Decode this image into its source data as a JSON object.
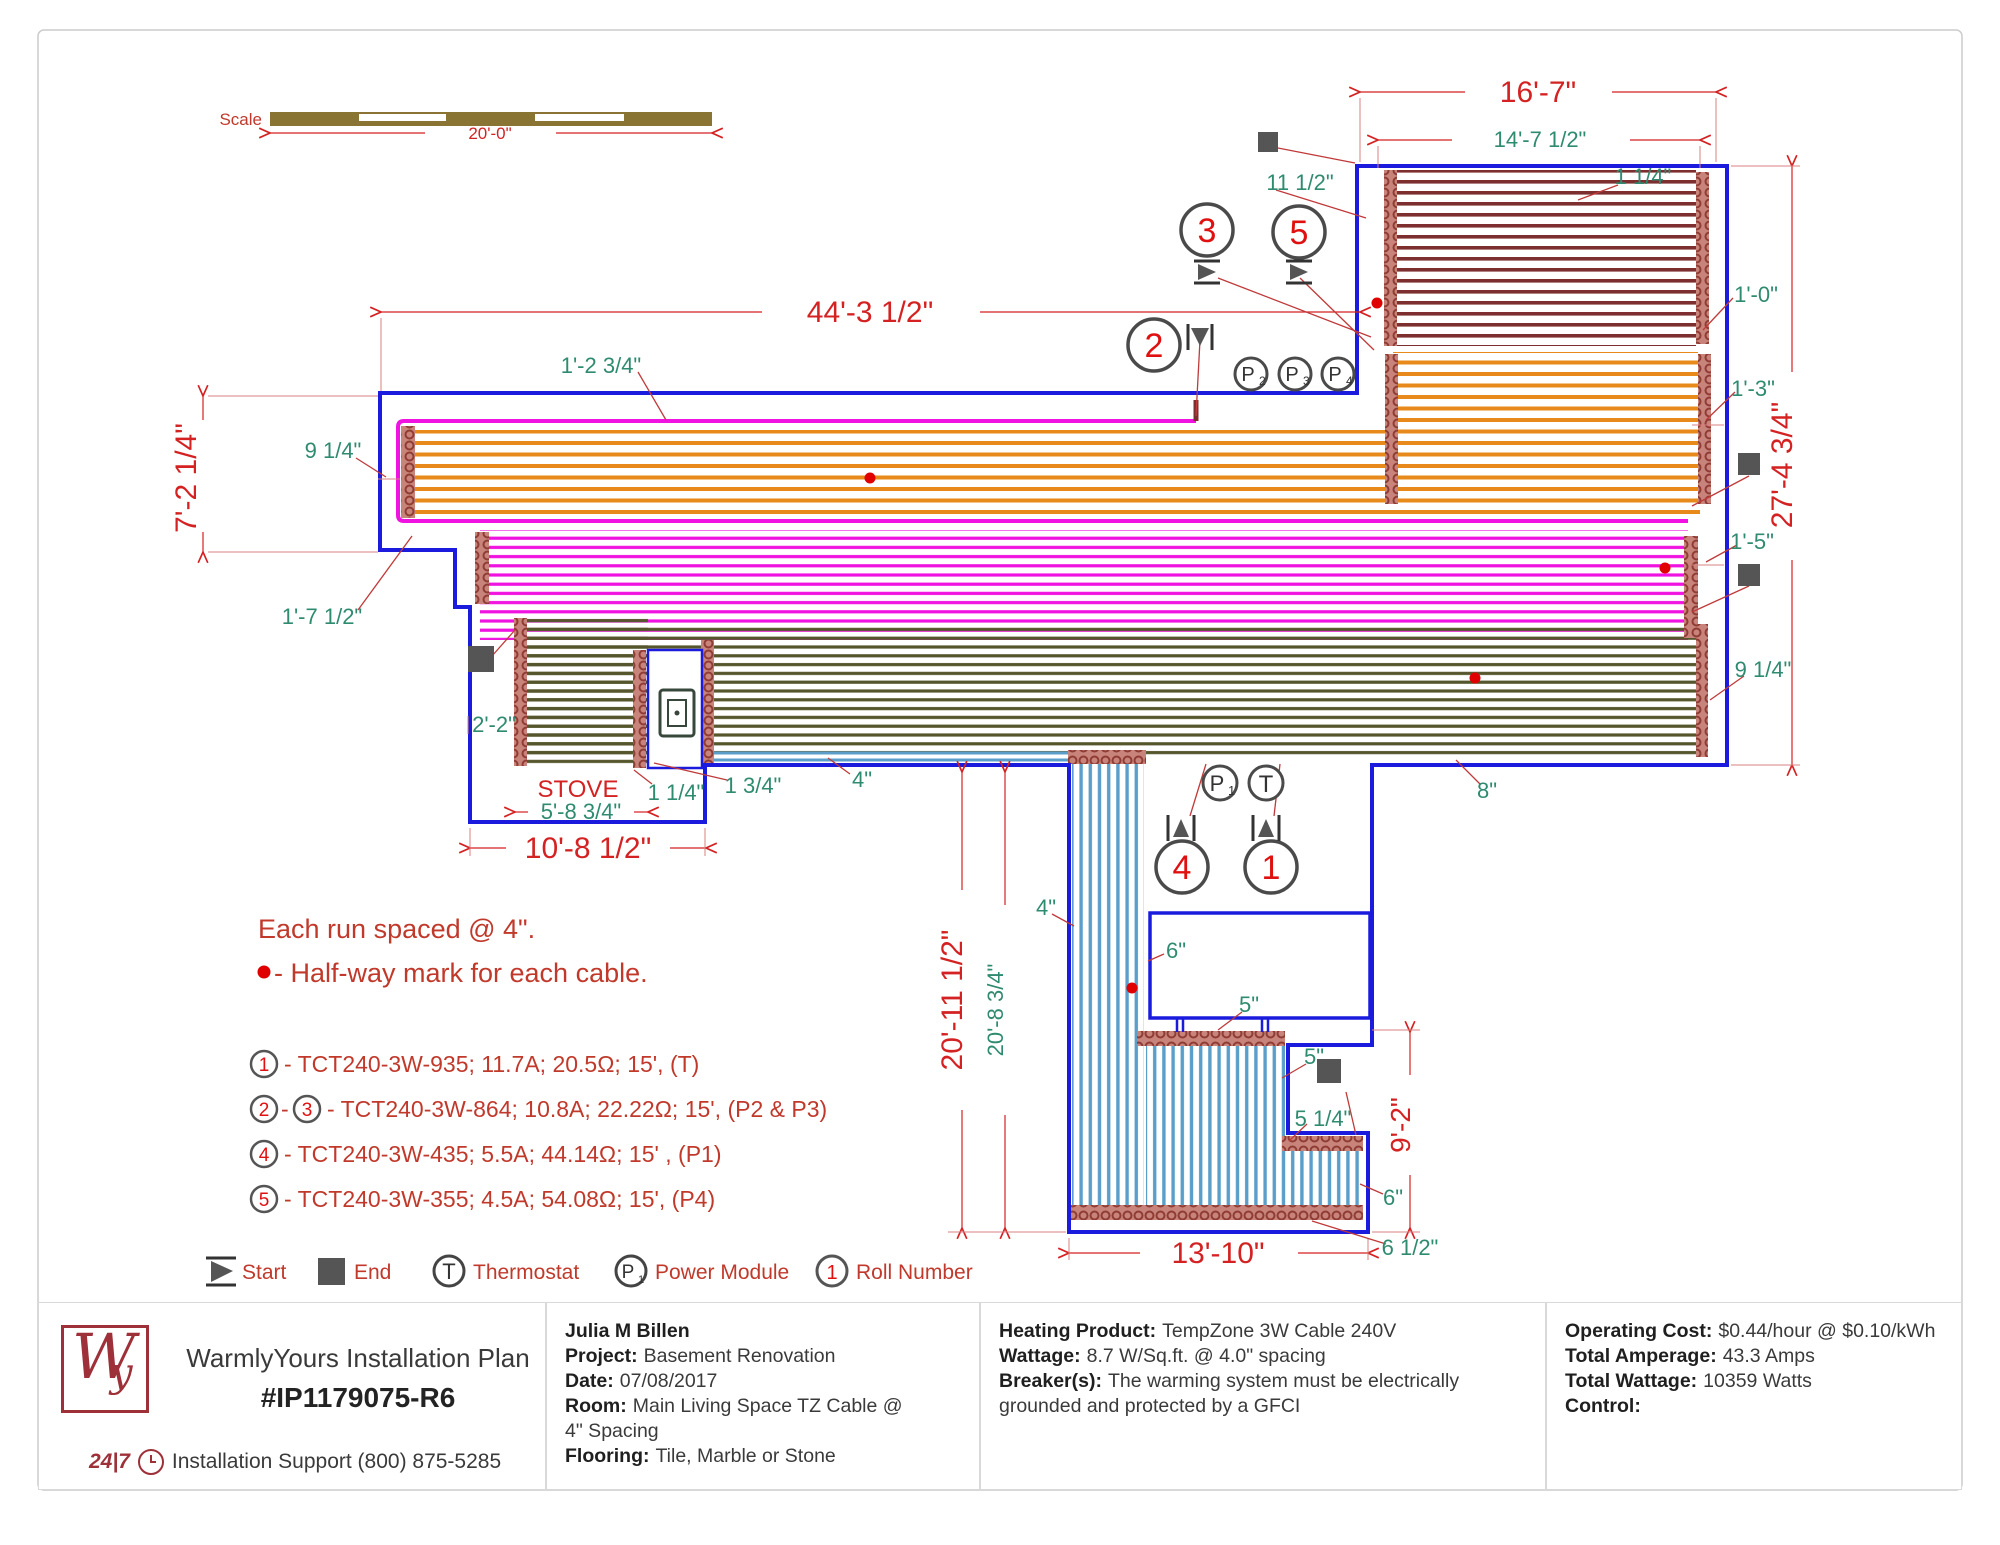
{
  "scale": {
    "label": "Scale",
    "length": "20'-0\""
  },
  "dims": {
    "top_width": "16'-7\"",
    "top_inner_width": "14'-7 1/2\"",
    "top_offset": "1 1/4\"",
    "top_left_offset": "11 1/2\"",
    "right_offset_a": "1'-0\"",
    "main_width": "44'-3 1/2\"",
    "band_offset": "1'-2 3/4\"",
    "left_height": "7'-2 1/4\"",
    "left_loop_offset": "9 1/4\"",
    "left_step": "1'-7 1/2\"",
    "right_offset_b": "1'-3\"",
    "right_height": "27'-4 3/4\"",
    "right_offset_c": "1'-5\"",
    "right_loop_offset": "9 1/4\"",
    "stove_offset": "2'-2\"",
    "stove_width": "5'-8 3/4\"",
    "left_block_width": "10'-8 1/2\"",
    "gap_a": "1 1/4\"",
    "gap_b": "1 3/4\"",
    "gap_c": "4\"",
    "olive_gap": "8\"",
    "mid_gap": "4\"",
    "bottom_height": "20'-11 1/2\"",
    "bottom_inner_height": "20'-8 3/4\"",
    "gap_d": "6\"",
    "gap_e": "5\"",
    "gap_f": "5\"",
    "gap_g": "5 1/4\"",
    "right_ext_height": "9'-2\"",
    "gap_h": "6\"",
    "bottom_width": "13'-10\"",
    "gap_i": "6 1/2\""
  },
  "labels": {
    "stove": "STOVE"
  },
  "notes": {
    "spacing": "Each run spaced @ 4\".",
    "halfway": "- Half-way mark for each cable."
  },
  "roll_list": {
    "r1": {
      "n1": "1",
      "text": "- TCT240-3W-935; 11.7A; 20.5Ω; 15', (T)"
    },
    "r2": {
      "n1": "2",
      "sep": "-",
      "n2": "3",
      "text": "- TCT240-3W-864; 10.8A; 22.22Ω; 15', (P2 & P3)"
    },
    "r3": {
      "n1": "4",
      "text": "- TCT240-3W-435; 5.5A; 44.14Ω; 15' , (P1)"
    },
    "r4": {
      "n1": "5",
      "text": "- TCT240-3W-355; 4.5A; 54.08Ω; 15', (P4)"
    }
  },
  "markers": {
    "c1": "1",
    "c2": "2",
    "c3": "3",
    "c4": "4",
    "c5": "5",
    "p": "P",
    "t": "T",
    "p1s": "1",
    "p2s": "2",
    "p3s": "3",
    "p4s": "4"
  },
  "legend": {
    "start": "Start",
    "end": "End",
    "thermostat": "Thermostat",
    "power_module": "Power Module",
    "roll_number": "Roll Number",
    "t": "T",
    "p": "P",
    "p_sub": "1",
    "one": "1"
  },
  "footer": {
    "title": "WarmlyYours Installation Plan",
    "plan_no": "#IP1179075-R6",
    "support_badge": "24|7",
    "support": "Installation Support (800) 875-5285",
    "logo_w": "W",
    "logo_y": "y",
    "customer": "Julia M Billen",
    "project_label": "Project:",
    "project": "Basement Renovation",
    "date_label": "Date:",
    "date": "07/08/2017",
    "room_label": "Room:",
    "room": "Main Living Space TZ Cable @ 4\" Spacing",
    "flooring_label": "Flooring:",
    "flooring": "Tile, Marble or Stone",
    "heating_label": "Heating Product:",
    "heating": "TempZone 3W Cable 240V",
    "wattage_label": "Wattage:",
    "wattage": "8.7 W/Sq.ft. @ 4.0\" spacing",
    "breaker_label": "Breaker(s):",
    "breaker": "The warming system must be electrically grounded and protected by a GFCI",
    "cost_label": "Operating Cost:",
    "cost": "$0.44/hour @ $0.10/kWh",
    "amperage_label": "Total Amperage:",
    "amperage": "43.3 Amps",
    "wattage_total_label": "Total Wattage:",
    "wattage_total": "10359 Watts",
    "control_label": "Control:",
    "control": ""
  },
  "colors": {
    "outline_blue": "#1b1bdd",
    "roll5_maroon": "#7d2f2f",
    "roll3_orange": "#e8891b",
    "roll2_magenta": "#f012e0",
    "roll1_olive": "#56562d",
    "roll4_blue": "#5b9ec9",
    "loop_band": "#c8847a",
    "dim_red": "#d42222",
    "dim_green": "#2f8b70",
    "logo_maroon": "#9e3039"
  }
}
